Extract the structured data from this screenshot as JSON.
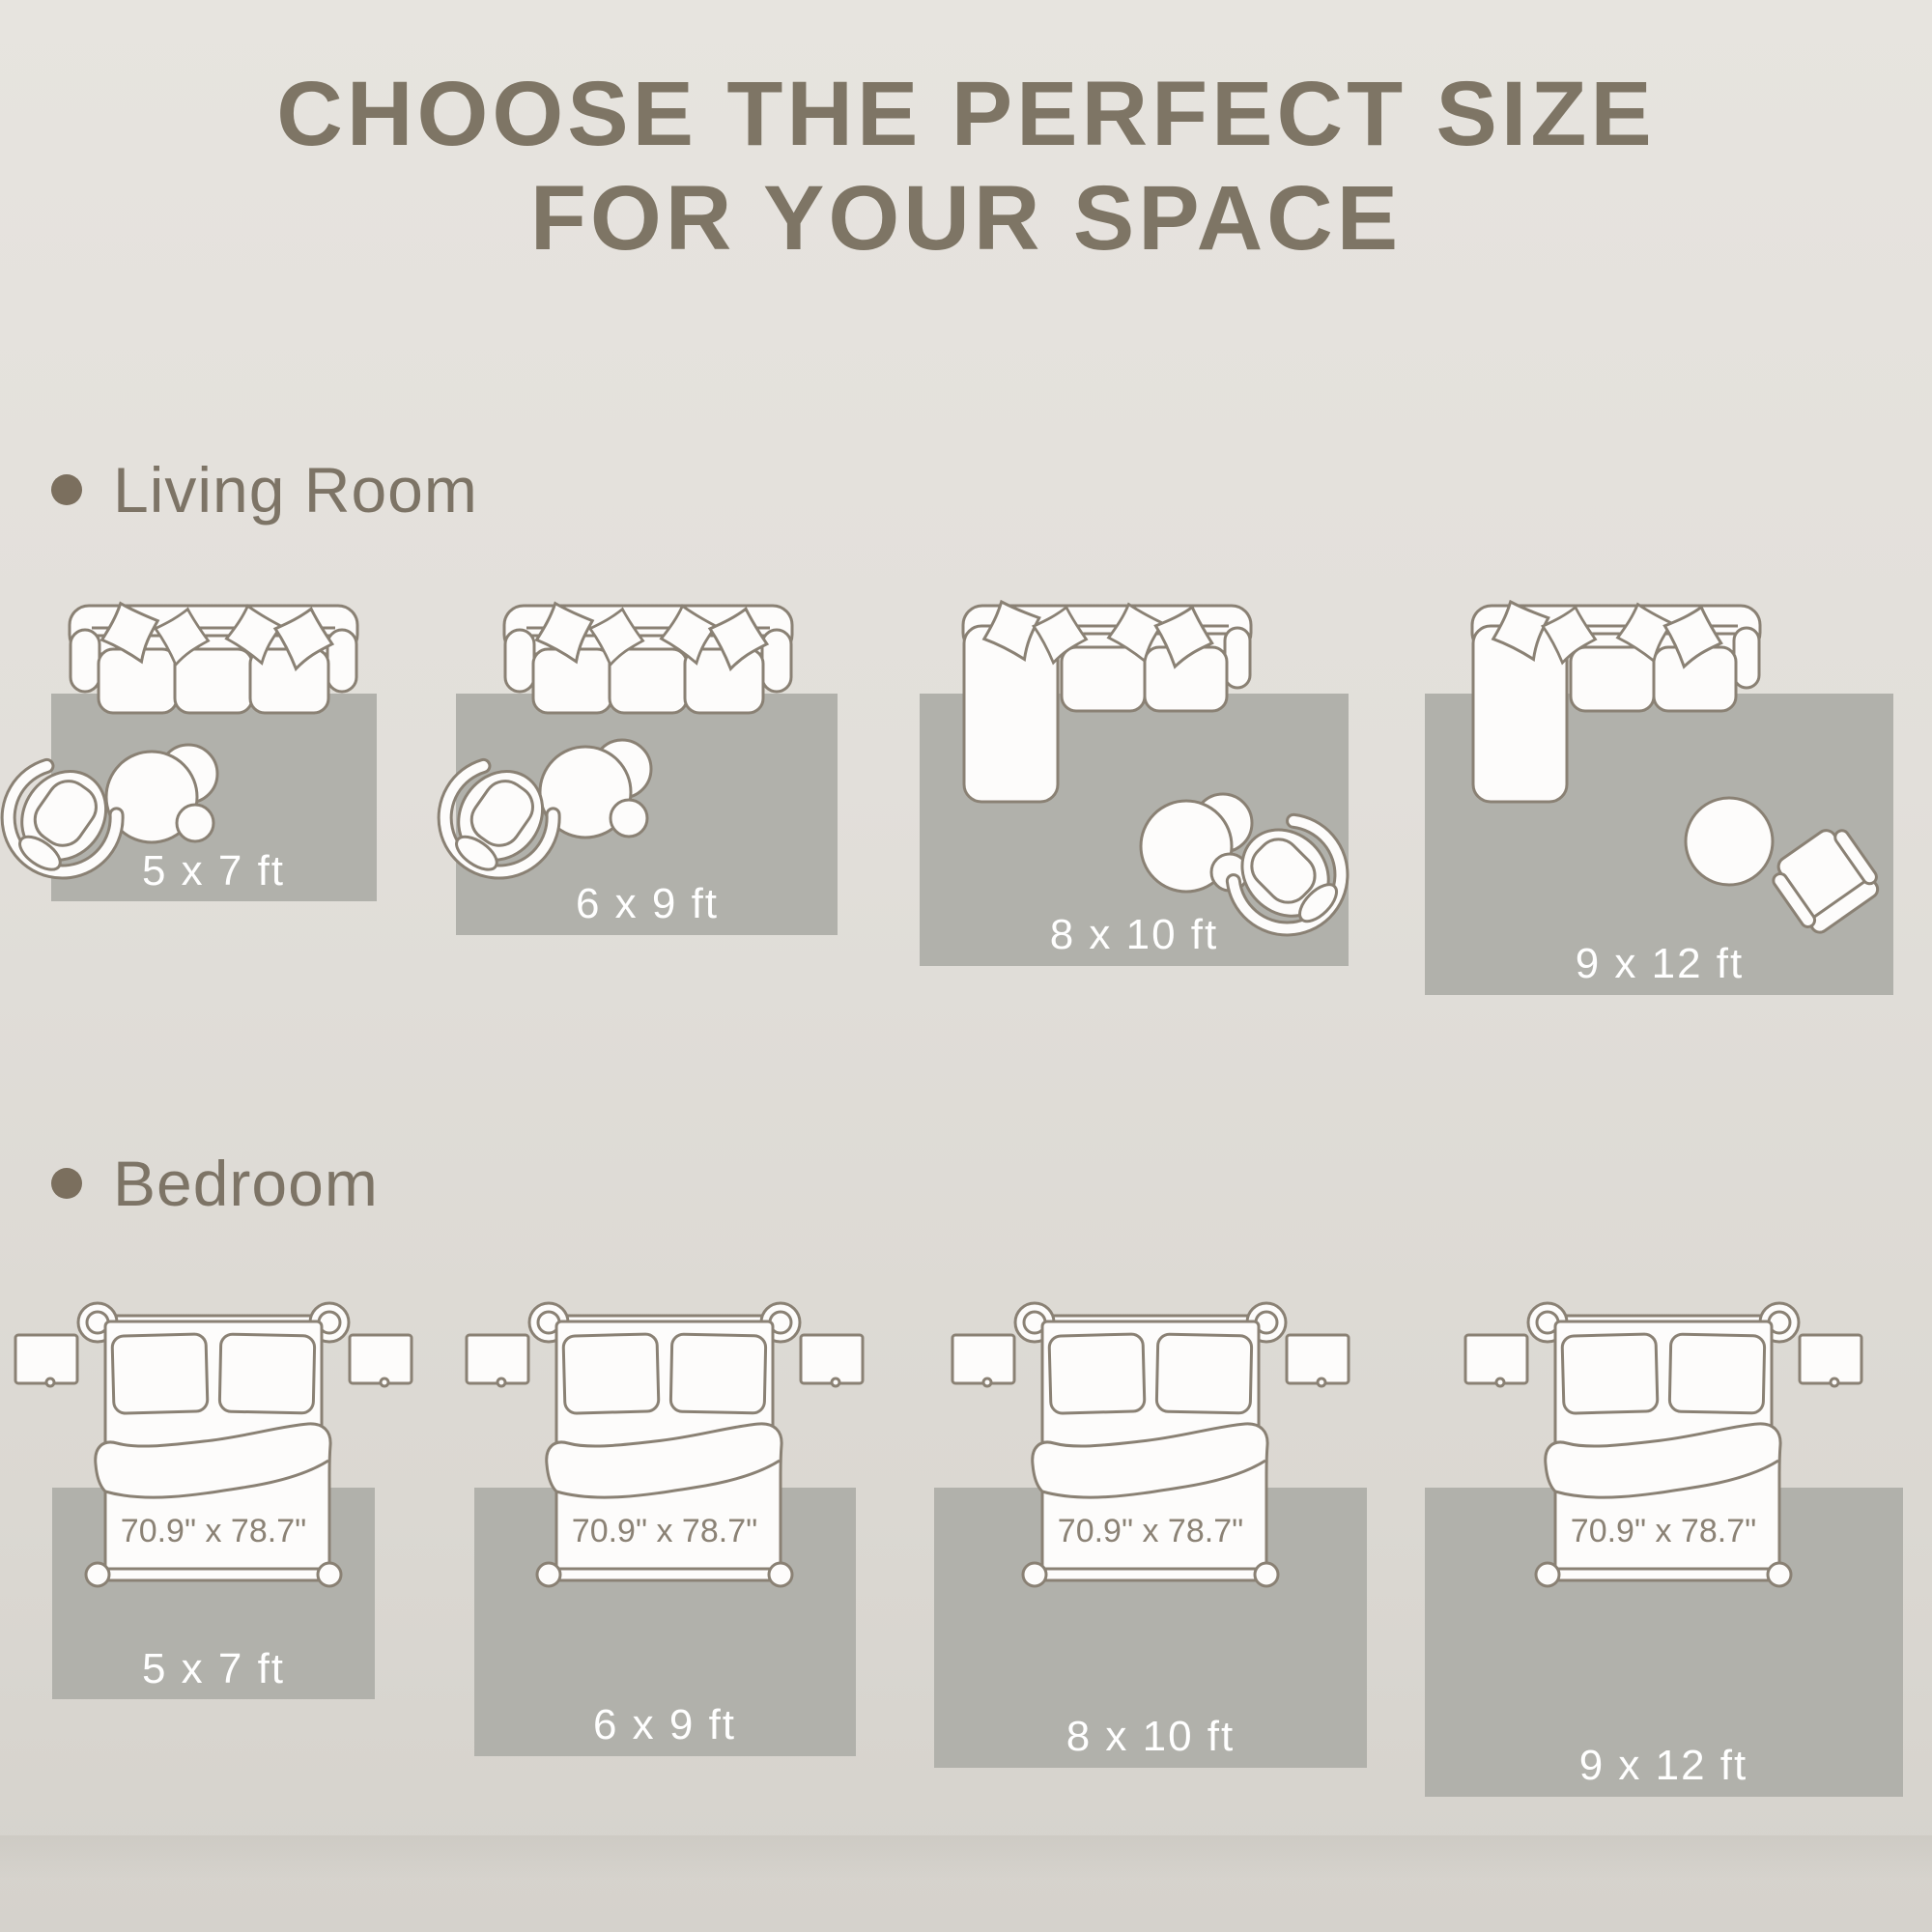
{
  "title": {
    "line1": "CHOOSE THE PERFECT SIZE",
    "line2": "FOR YOUR SPACE"
  },
  "sections": {
    "living_room": {
      "label": "Living Room",
      "rugs": [
        {
          "size": "5 x 7 ft"
        },
        {
          "size": "6 x 9 ft"
        },
        {
          "size": "8 x 10 ft"
        },
        {
          "size": "9 x 12 ft"
        }
      ]
    },
    "bedroom": {
      "label": "Bedroom",
      "bed_size": "70.9\" x 78.7\"",
      "rugs": [
        {
          "size": "5 x 7 ft"
        },
        {
          "size": "6 x 9 ft"
        },
        {
          "size": "8 x 10 ft"
        },
        {
          "size": "9 x 12 ft"
        }
      ]
    }
  },
  "icons": {
    "sofa": "three-seat-sofa-top-view",
    "sectional": "l-shaped-sectional-sofa-top-view",
    "round_chair": "round-lounge-chair-top-view",
    "square_chair": "armchair-top-view",
    "coffee_table": "nesting-coffee-tables-top-view",
    "round_table": "round-side-table-top-view",
    "bed": "double-bed-top-view",
    "nightstand": "nightstand-top-view"
  },
  "colors": {
    "background": "#e2dfda",
    "rug": "#b1b1ab",
    "outline": "#8a8174",
    "furniture_fill": "#fdfcfb",
    "heading_text": "#7e7565",
    "section_text": "#7d7466",
    "bullet": "#7b6f5e",
    "rug_label_text": "#ffffff",
    "bed_dimension_text": "#8b8275"
  }
}
